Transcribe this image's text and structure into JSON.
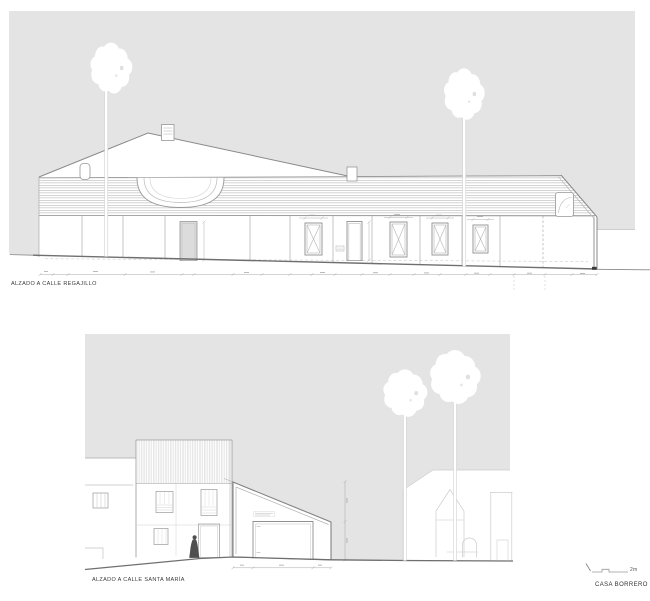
{
  "document": {
    "type": "architectural-elevation-sheet",
    "project": "CASA BORRERO"
  },
  "elevations": {
    "top": {
      "label": "ALZADO A CALLE REGAJILLO"
    },
    "bottom": {
      "label": "ALZADO A CALLE SANTA MARÍA"
    }
  },
  "titleblock": {
    "project_name": "CASA BORRERO",
    "scale_text": "2m"
  },
  "colors": {
    "backdrop_gray": "#e4e4e4",
    "line_gray": "#8f8f8f",
    "faint_gray": "#cccccc",
    "ground_gray": "#6f6f6f",
    "text_dark": "#3a3a3a",
    "silhouette_dark": "#4f4f4f",
    "door_fill_gray": "#dcdcdc"
  }
}
